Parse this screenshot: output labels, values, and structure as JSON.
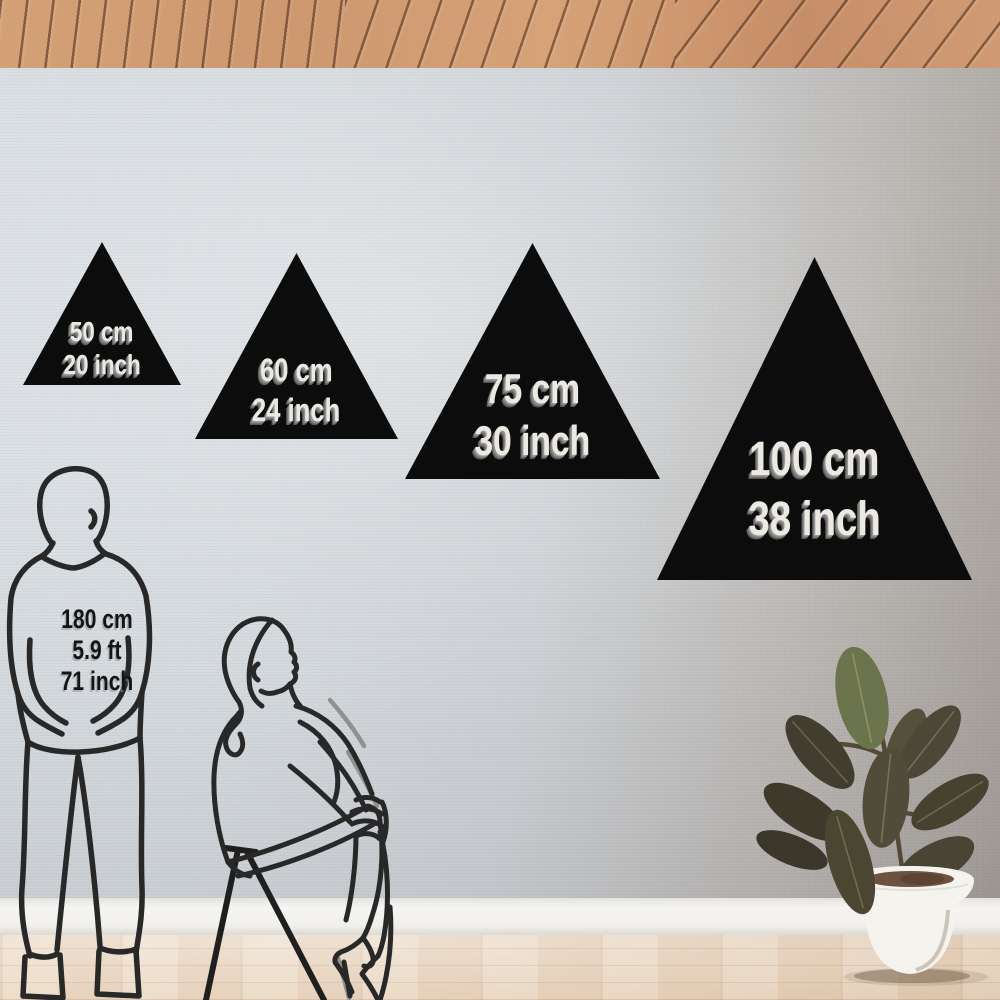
{
  "scene": {
    "description": "Room mockup comparing triangle wall-decal sizes against human figures",
    "colors": {
      "decal": "#0c0c0c",
      "decal_text": "#ece9e3",
      "wall_left": "#d8dde2",
      "wall_right": "#a8a29c",
      "ceiling_wood": "#cd9770",
      "baseboard": "#f1f0ec",
      "floor_wood": "#e9d7c3",
      "figure_line": "#282828",
      "plant_pot": "#f5f3ee",
      "plant_leaf": "#4a4535"
    }
  },
  "decals": [
    {
      "id": "50",
      "line1": "50 cm",
      "line2": "20 inch"
    },
    {
      "id": "60",
      "line1": "60 cm",
      "line2": "24 inch"
    },
    {
      "id": "75",
      "line1": "75 cm",
      "line2": "30 inch"
    },
    {
      "id": "100",
      "line1": "100 cm",
      "line2": "38 inch"
    }
  ],
  "reference_person": {
    "line1": "180 cm",
    "line2": "5.9 ft",
    "line3": "71 inch"
  }
}
